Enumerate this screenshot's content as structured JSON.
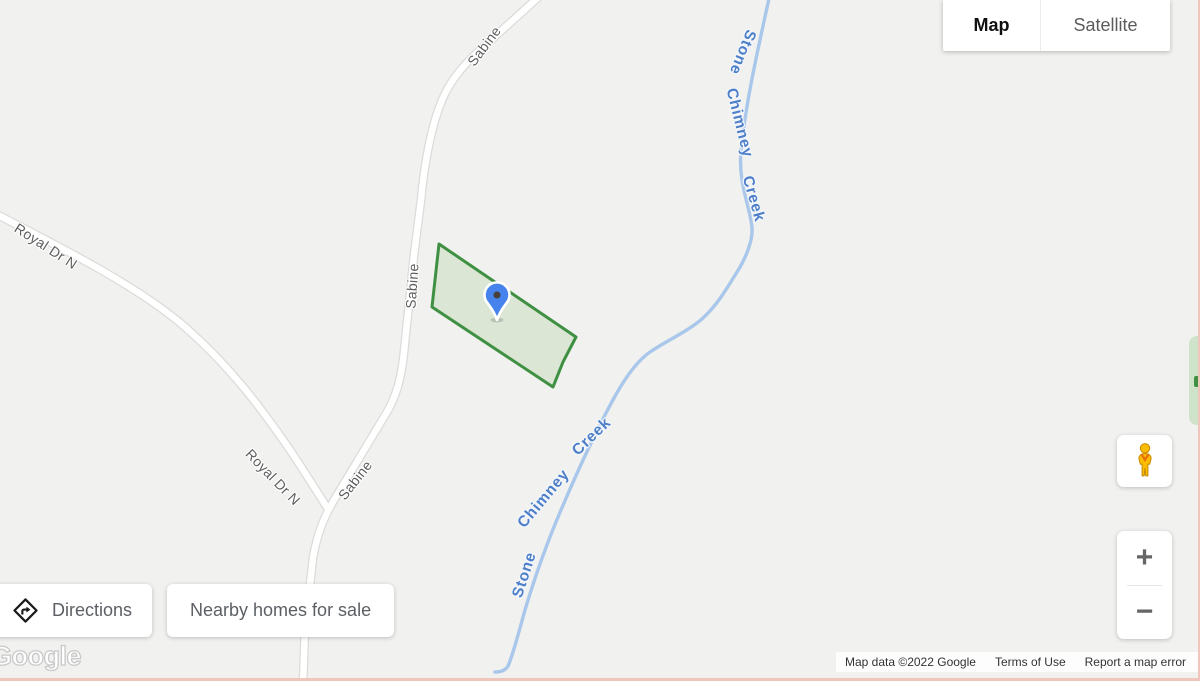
{
  "window": {
    "type": "google-map-embed"
  },
  "map_type_control": {
    "map_label": "Map",
    "satellite_label": "Satellite",
    "active": "Map"
  },
  "action_buttons": {
    "directions_label": "Directions",
    "nearby_label": "Nearby homes for sale"
  },
  "road_labels": [
    {
      "text": "Sabine"
    },
    {
      "text": "Royal Dr N"
    },
    {
      "text": "Sabine"
    },
    {
      "text": "Royal Dr N"
    },
    {
      "text": "Sabine"
    }
  ],
  "water_labels": [
    {
      "words": [
        "Stone",
        "Chimney",
        "Creek"
      ]
    },
    {
      "words": [
        "Stone",
        "Chimney",
        "Creek"
      ]
    }
  ],
  "parcel": {
    "type": "highlighted-property-polygon",
    "fill": "#d9e5d3",
    "stroke": "#3f9043"
  },
  "pin": {
    "type": "property-location-pin",
    "color": "#4683ec"
  },
  "street_view": {
    "icon": "pegman-icon"
  },
  "zoom_control": {
    "zoom_in": "+",
    "zoom_out": "−"
  },
  "attribution": {
    "logo": "Google",
    "map_data": "Map data ©2022 Google",
    "terms_of_use": "Terms of Use",
    "report_error": "Report a map error"
  },
  "icons": {
    "directions": "directions-diamond-arrow-icon",
    "pegman": "pegman-icon",
    "zoom_in": "plus-icon",
    "zoom_out": "minus-icon",
    "pin": "map-pin-icon"
  },
  "colors": {
    "map_background": "#f1f1ef",
    "road_fill": "#ffffff",
    "road_casing": "#dcdbd8",
    "creek": "#a9c7eb",
    "water_label": "#4d7fc8",
    "road_label": "#5e5e5e",
    "frame_border": "#f0c5bc"
  }
}
